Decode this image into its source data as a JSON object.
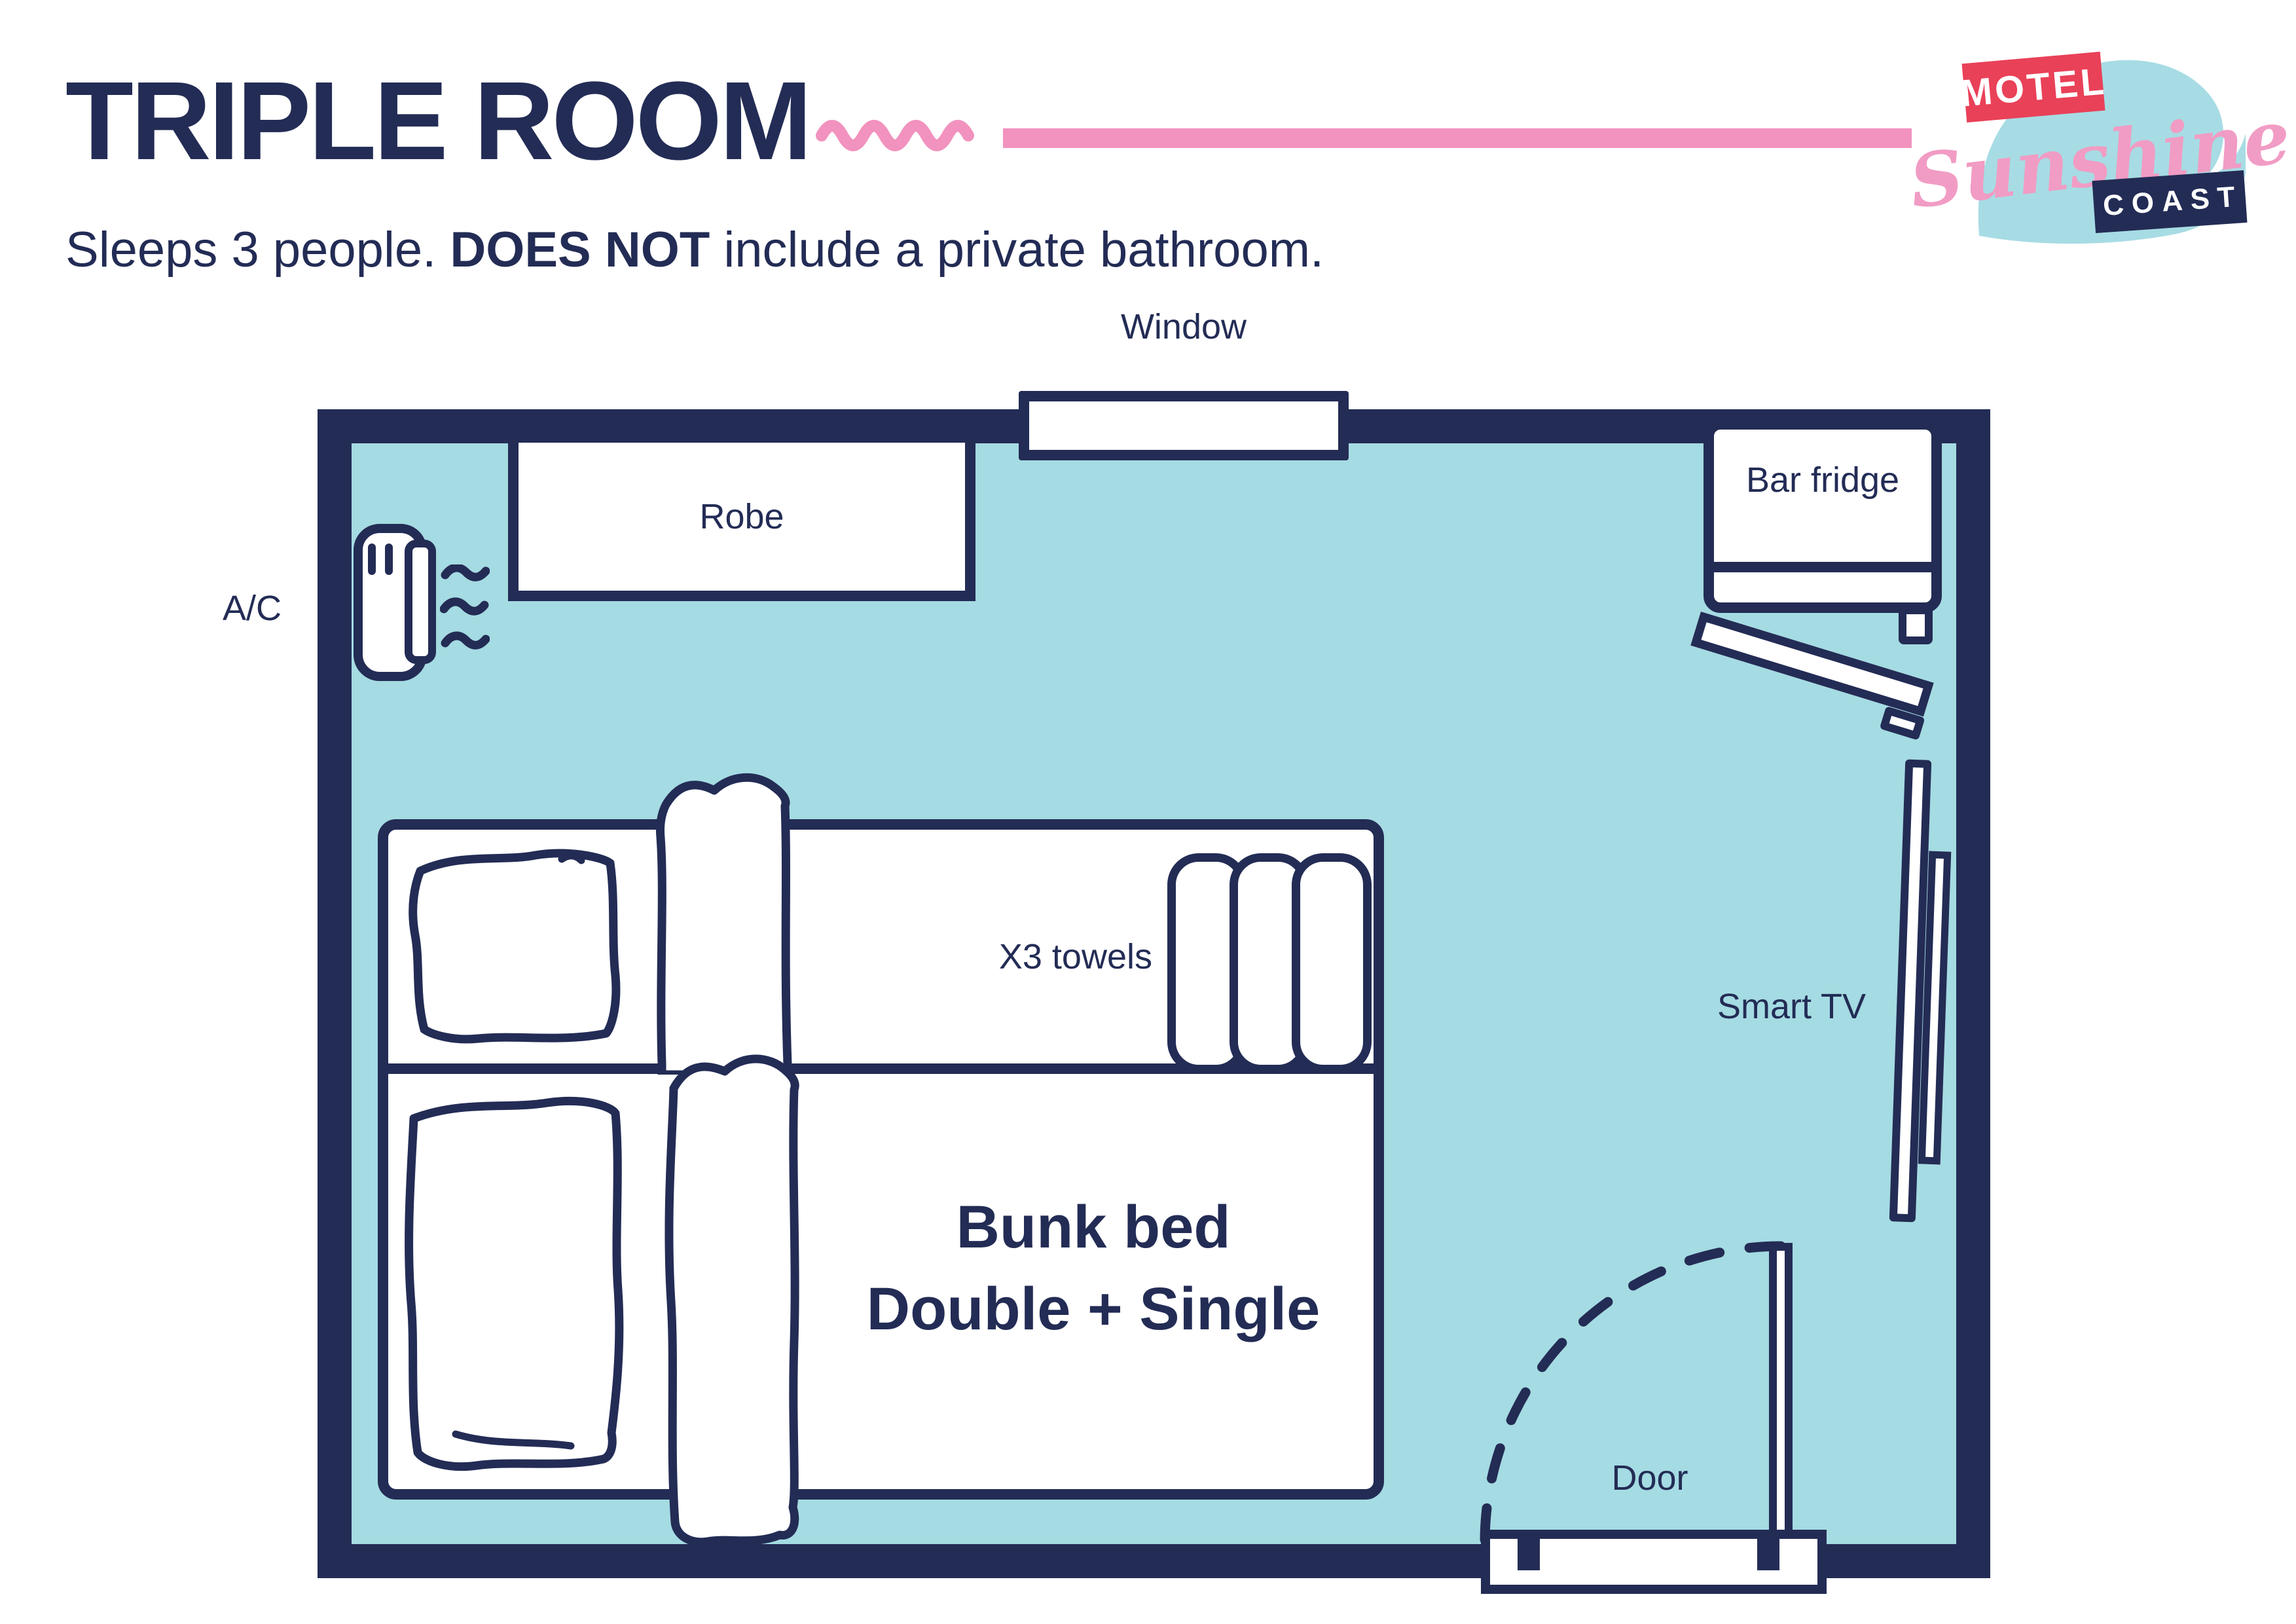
{
  "header": {
    "title": "TRIPLE ROOM",
    "subtitle": {
      "part1": "Sleeps 3 people. ",
      "part2": "DOES NOT",
      "part3": " include a private bathroom."
    }
  },
  "logo": {
    "motel": "MOTEL",
    "sunshine": "Sunshine",
    "coast": "COAST"
  },
  "floorplan": {
    "window_label": "Window",
    "robe_label": "Robe",
    "ac_label": "A/C",
    "bar_fridge_label": "Bar fridge",
    "towels_label": "X3 towels",
    "smart_tv_label": "Smart TV",
    "door_label": "Door",
    "bunk_bed_line1": "Bunk bed",
    "bunk_bed_line2": "Double + Single"
  },
  "colors": {
    "navy": "#232C55",
    "room_fill": "#A5DBE2",
    "pink_accent": "#F292BE",
    "logo_red": "#E94158",
    "logo_pink": "#F19CC4",
    "white": "#FFFFFF"
  }
}
